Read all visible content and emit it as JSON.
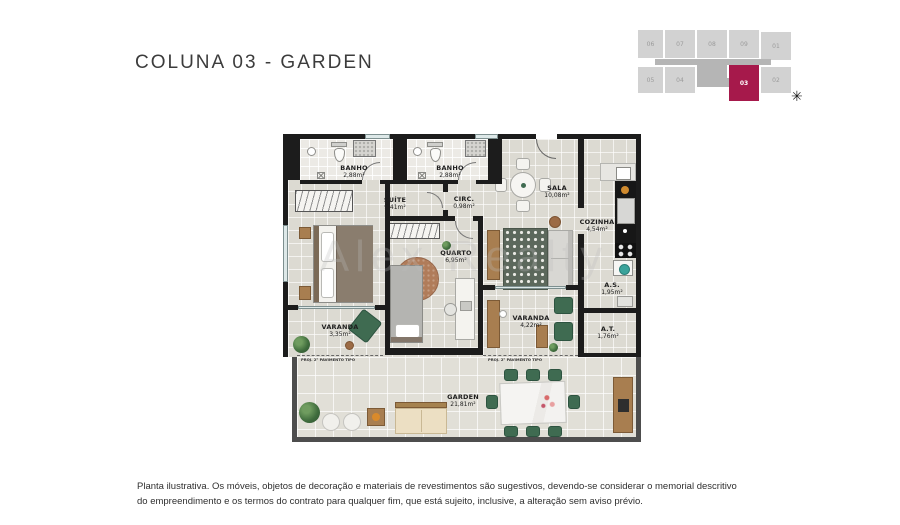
{
  "title": "COLUNA 03 - GARDEN",
  "key_plan": {
    "units_top": [
      "06",
      "07",
      "08",
      "09",
      "01"
    ],
    "units_bottom": [
      "05",
      "04",
      "03",
      "02"
    ],
    "highlighted_unit": "03",
    "highlight_color": "#a6194b",
    "compass_glyph": "✳"
  },
  "floor_plan": {
    "rooms": [
      {
        "name": "BANHO",
        "area": "2,88m²"
      },
      {
        "name": "BANHO",
        "area": "2,88m²"
      },
      {
        "name": "SUÍTE",
        "area": "9,41m²"
      },
      {
        "name": "CIRC.",
        "area": "0,98m²"
      },
      {
        "name": "SALA",
        "area": "10,08m²"
      },
      {
        "name": "COZINHA",
        "area": "4,54m²"
      },
      {
        "name": "QUARTO",
        "area": "6,95m²"
      },
      {
        "name": "A.S.",
        "area": "1,95m²"
      },
      {
        "name": "VARANDA",
        "area": "3,35m²"
      },
      {
        "name": "VARANDA",
        "area": "4,22m²"
      },
      {
        "name": "A.T.",
        "area": "1,76m²"
      },
      {
        "name": "GARDEN",
        "area": "21,81m²"
      }
    ],
    "annotations": {
      "proj_left": "PROJ. 2° PAVIMENTO TIPO",
      "proj_right": "PROJ. 2° PAVIMENTO TIPO"
    }
  },
  "watermark": "Alex Realty",
  "footer": {
    "line1": "Planta ilustrativa. Os móveis, objetos de decoração e materiais de revestimentos são sugestivos, devendo-se considerar o memorial descritivo",
    "line2": "do empreendimento e os termos do contrato para qualquer fim, que está sujeito, inclusive, a alteração sem aviso prévio."
  }
}
